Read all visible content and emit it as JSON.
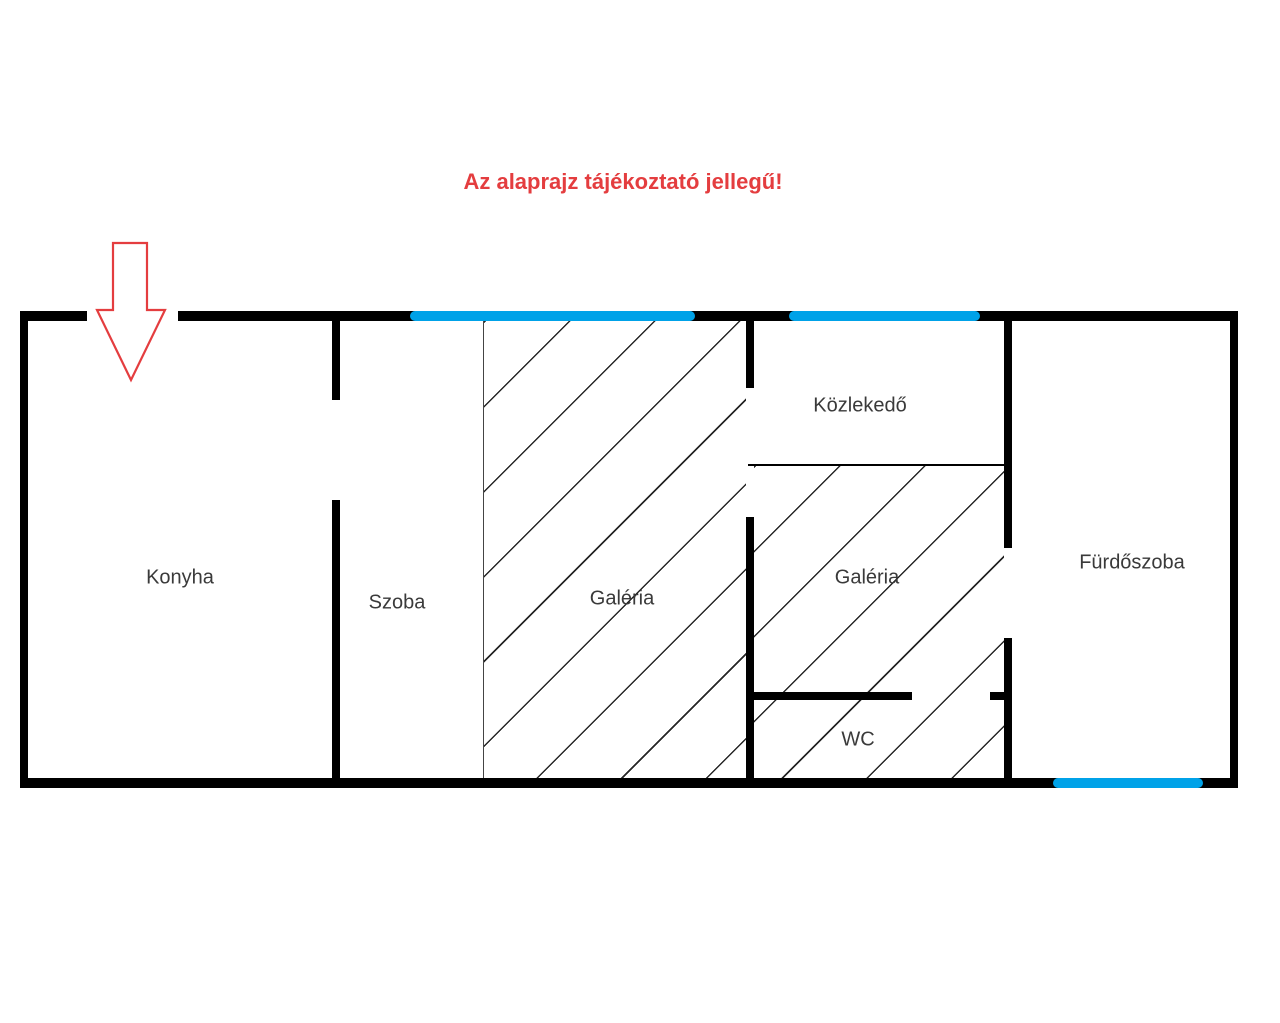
{
  "disclaimer": {
    "text": "Az alaprajz tájékoztató jellegű!"
  },
  "rooms": {
    "konyha": {
      "label": "Konyha"
    },
    "szoba": {
      "label": "Szoba"
    },
    "galeria_nagy": {
      "label": "Galéria"
    },
    "kozlekedo": {
      "label": "Közlekedő"
    },
    "galeria_kis": {
      "label": "Galéria"
    },
    "wc": {
      "label": "WC"
    },
    "furdoszoba": {
      "label": "Fürdőszoba"
    }
  },
  "icons": {
    "entrance_arrow": "down-arrow"
  },
  "colors": {
    "wall": "#000000",
    "window_blue": "#00a2e8",
    "red": "#e43d3f",
    "label": "#3a3a3a"
  }
}
